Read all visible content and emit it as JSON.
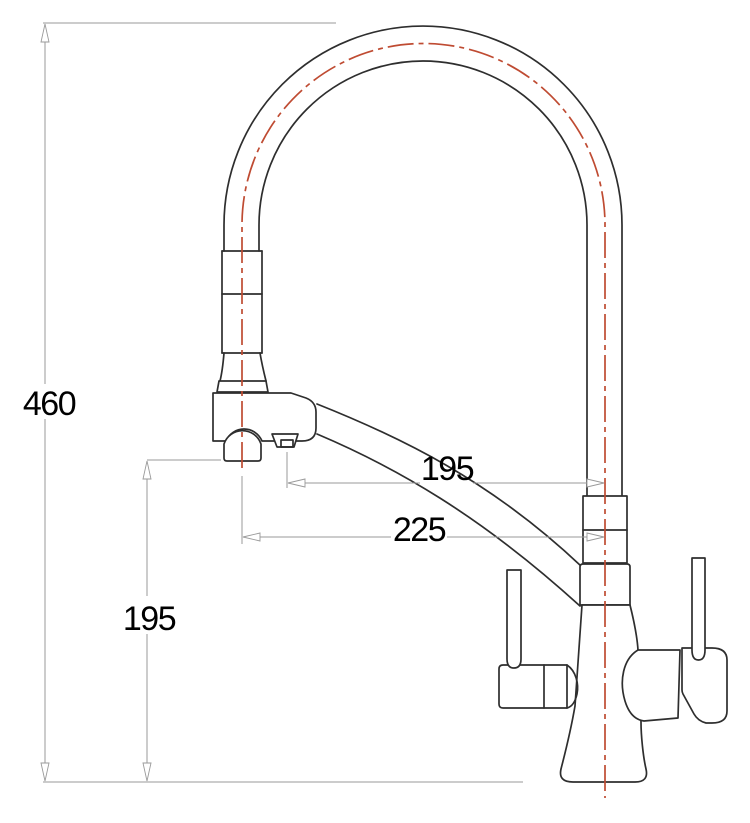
{
  "drawing": {
    "subject": "kitchen-faucet-pullout-spray-technical-drawing",
    "labels": {
      "overall_height": "460",
      "spray_outlet_height": "195",
      "upper_reach": "195",
      "lower_reach": "225"
    },
    "colors": {
      "outline": "#2e2e2e",
      "centerline": "#bf4b32",
      "dimension_lines": "#9a9a9a",
      "label_text": "#000000",
      "background": "#ffffff"
    }
  }
}
